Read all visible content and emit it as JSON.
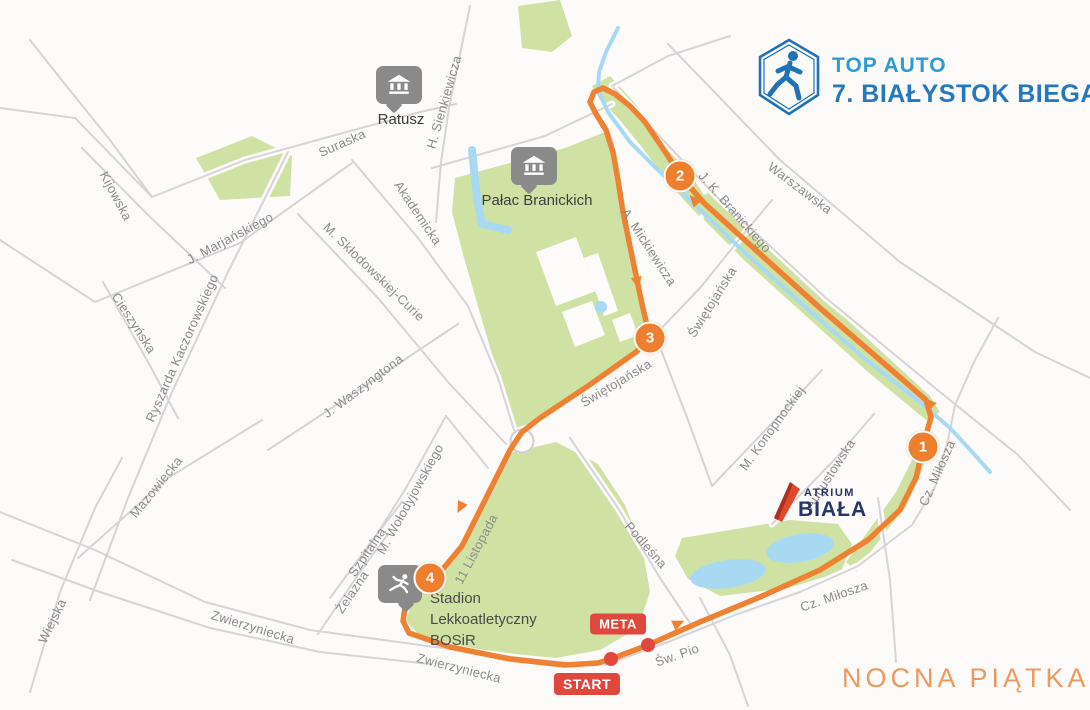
{
  "branding": {
    "logo_line1": "TOP AUTO",
    "logo_line2": "7. BIAŁYSTOK BIEGA",
    "event_name": "NOCNA PIĄTKA"
  },
  "atrium": {
    "line1": "ATRIUM",
    "line2": "BIAŁA"
  },
  "markers": {
    "start": "START",
    "meta": "META"
  },
  "checkpoints": [
    {
      "number": "1"
    },
    {
      "number": "2"
    },
    {
      "number": "3"
    },
    {
      "number": "4"
    }
  ],
  "landmarks": {
    "ratusz": {
      "label": "Ratusz"
    },
    "palac": {
      "label": "Pałac Branickich"
    },
    "stadium": {
      "lines": [
        "Stadion",
        "Lekkoatletyczny",
        "BOSiR"
      ]
    }
  },
  "street_labels": [
    {
      "text": "Kijowska"
    },
    {
      "text": "Suraska"
    },
    {
      "text": "H. Sienkiewicza"
    },
    {
      "text": "Warszawska"
    },
    {
      "text": "J. K. Branickiego"
    },
    {
      "text": "A. Mickiewicza"
    },
    {
      "text": "Świętojańska"
    },
    {
      "text": "Świętojańska"
    },
    {
      "text": "M. Konopnockiej"
    },
    {
      "text": "Augustowska"
    },
    {
      "text": "Akademicka"
    },
    {
      "text": "M. Skłodowskiej-Curie"
    },
    {
      "text": "J. Marjańskiego"
    },
    {
      "text": "Cieszyńska"
    },
    {
      "text": "Ryszarda Kaczorowskiego"
    },
    {
      "text": "J. Waszyngtona"
    },
    {
      "text": "Mazowiecka"
    },
    {
      "text": "M. Wołodyjowskiego"
    },
    {
      "text": "11 Listopada"
    },
    {
      "text": "Szpitalna"
    },
    {
      "text": "Żelazna"
    },
    {
      "text": "Wiejska"
    },
    {
      "text": "Zwierzyniecka"
    },
    {
      "text": "Zwierzyniecka"
    },
    {
      "text": "Podleśna"
    },
    {
      "text": "Św. Pio"
    },
    {
      "text": "Cz. Miłosza"
    },
    {
      "text": "Cz. Miłosza"
    }
  ],
  "colors": {
    "route_orange": "#ee8132",
    "park_green": "#cfe2a4",
    "water_blue": "#a7daf2",
    "street_gray": "#d8d3d6",
    "marker_red": "#e0473d",
    "brand_blue": "#2e9bd4",
    "brand_blue_dark": "#2478bf",
    "event_orange": "#ef985e",
    "atrium_navy": "#27356b"
  }
}
